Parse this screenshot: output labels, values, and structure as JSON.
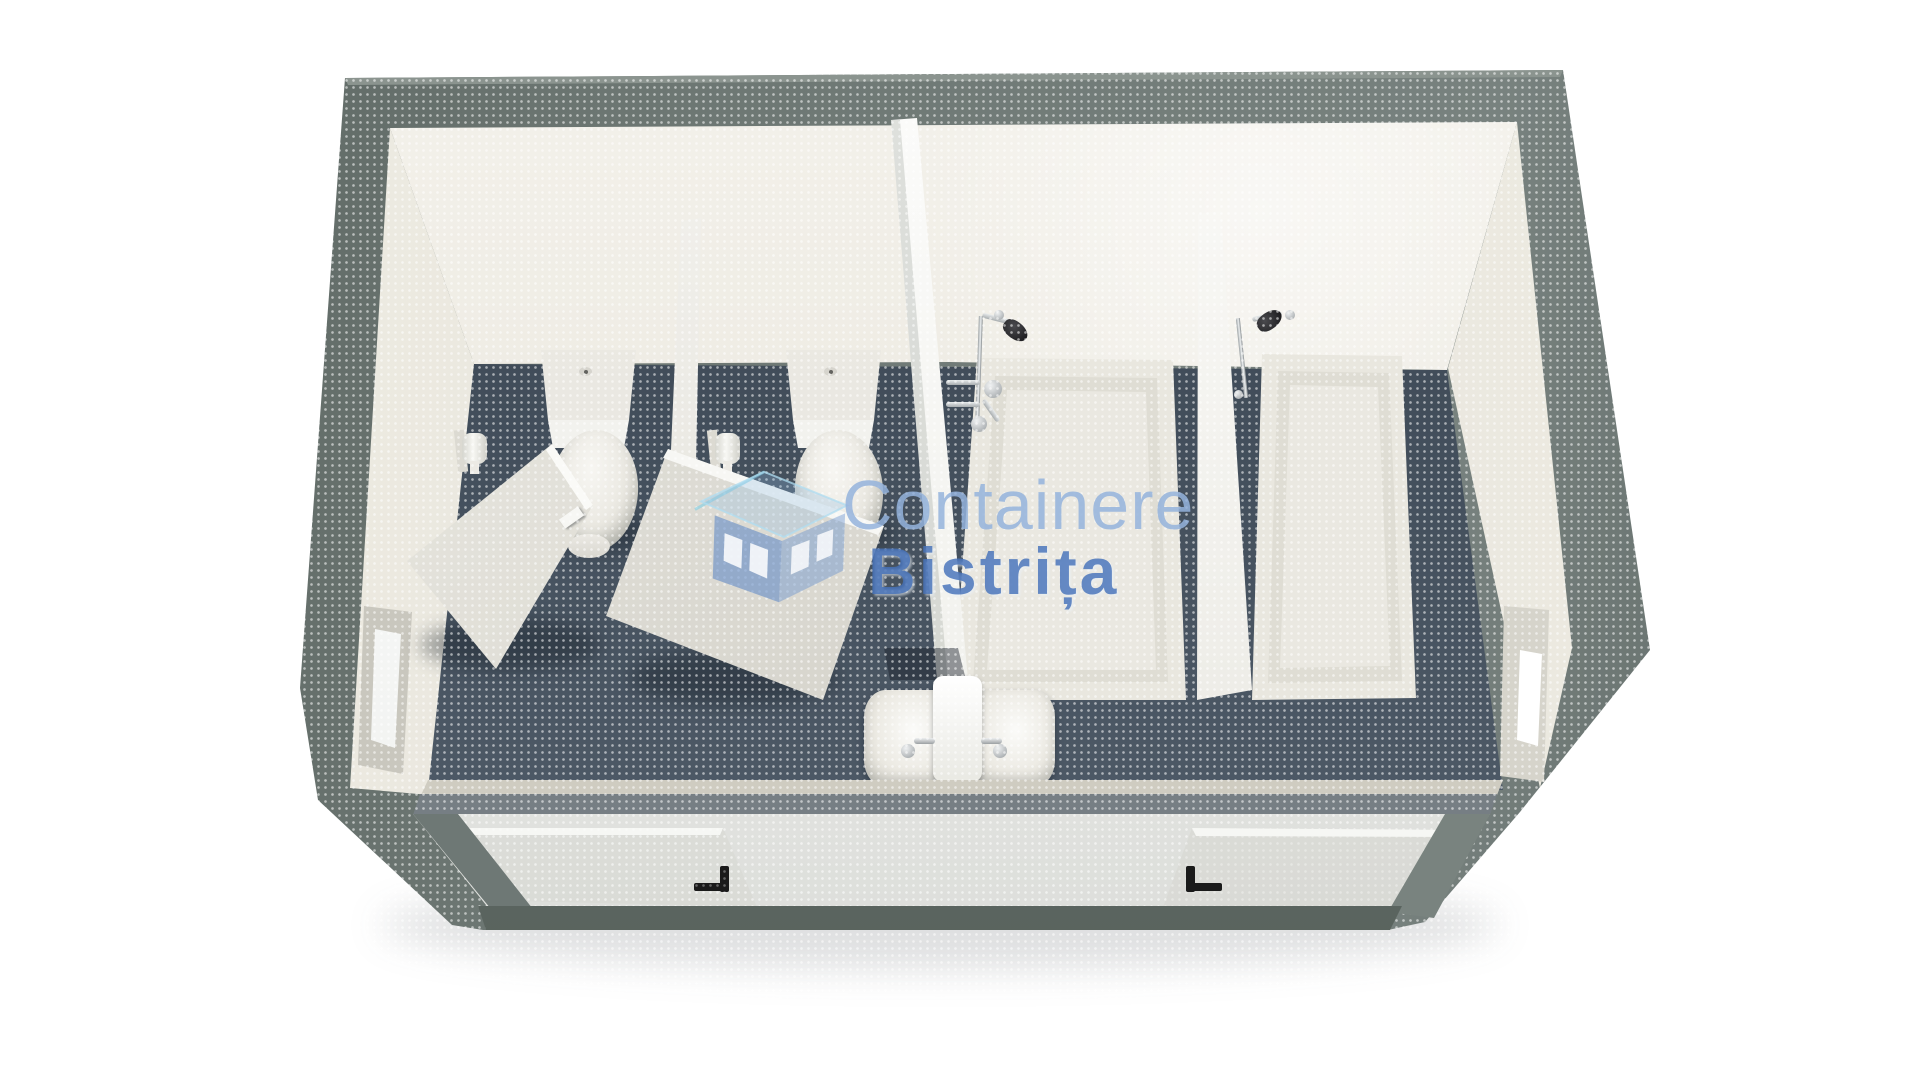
{
  "watermark": {
    "line1": "Containere",
    "line2": "Bistrița",
    "logo_icon": "house-icon",
    "line1_color": "#94b3dc",
    "line2_color": "#4672ba"
  },
  "icons": {
    "door_handle": "l-shaped-handle-icon",
    "shower_head": "shower-head-icon",
    "toilet_flush": "flush-button-icon"
  },
  "colors": {
    "background": "#ffffff",
    "frame_gray": "#6c7672",
    "frame_dark": "#59635f",
    "front_strip": "#80888d",
    "front_face": "#e8e9e7",
    "bottom_band": "#5f6a64",
    "wall_cream": "#ece9e0",
    "wall_bright": "#f4f2ec",
    "floor_back": "#37424e",
    "floor_front": "#55616e",
    "fixture_white": "#e9e7df",
    "divider_white": "#fcfcfa",
    "chrome": "#c2c6c9",
    "handle_black": "#1a1a1a"
  }
}
